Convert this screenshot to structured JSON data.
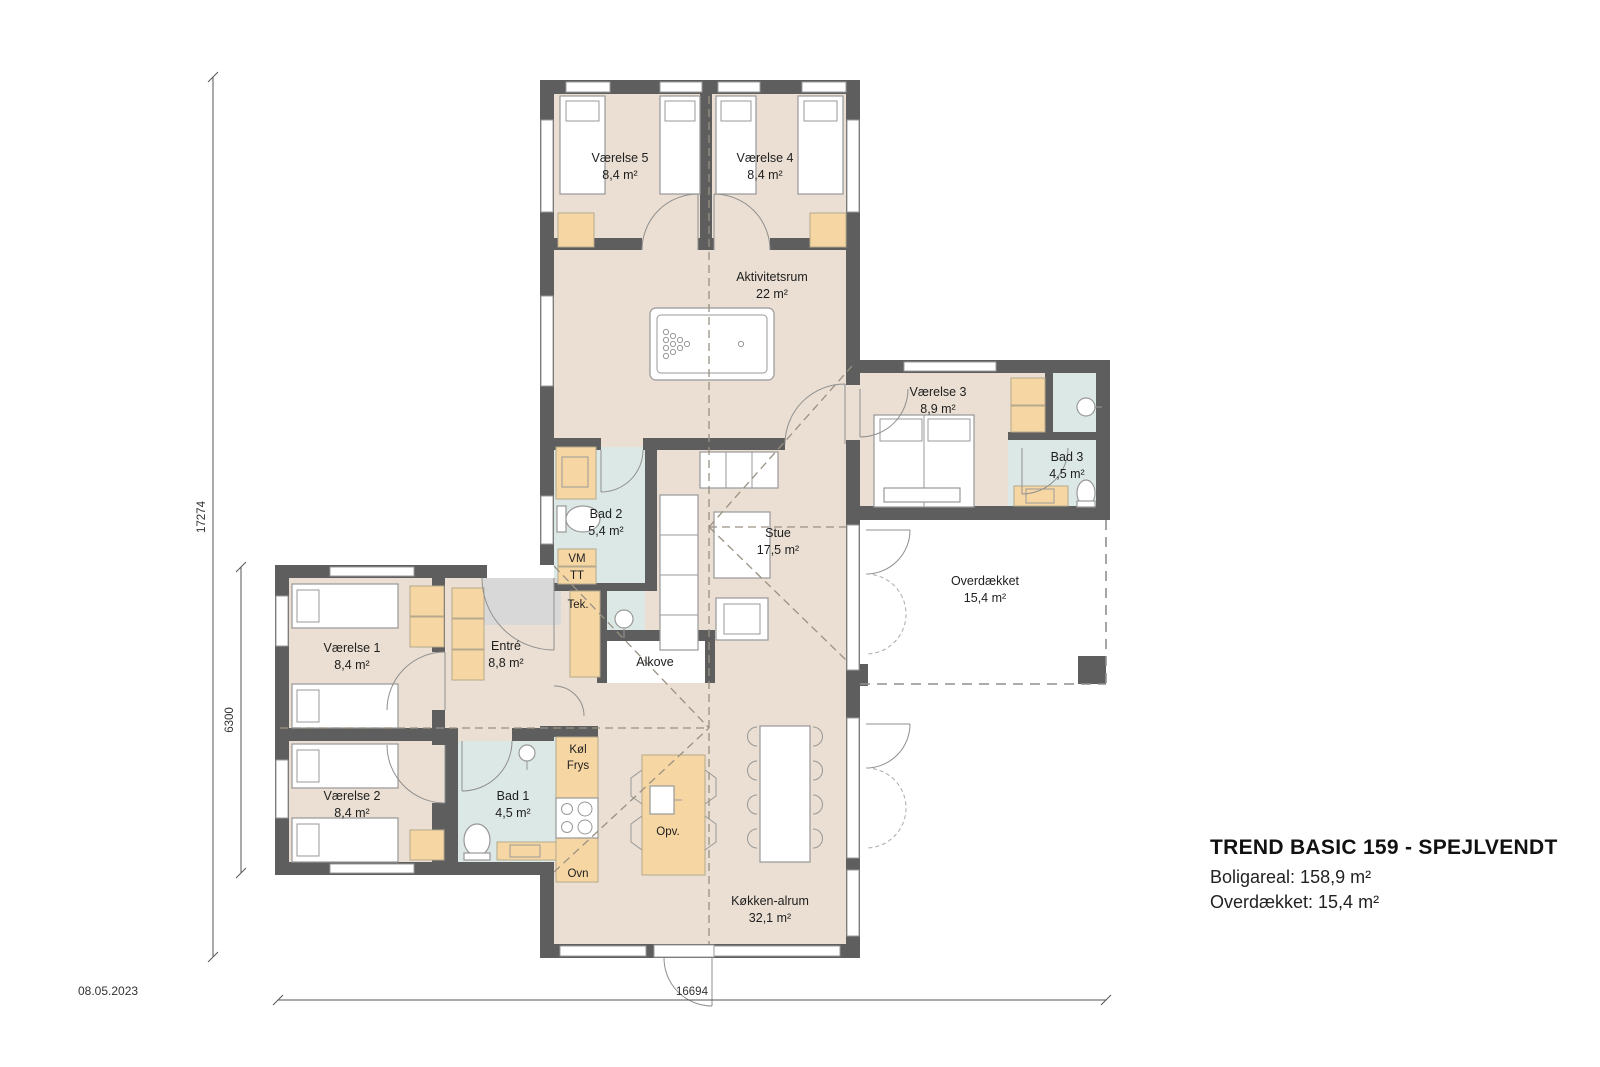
{
  "title_block": {
    "title": "TREND BASIC 159 - SPEJLVENDT",
    "boligareal": "Boligareal: 158,9 m²",
    "overdaekket": "Overdækket: 15,4 m²"
  },
  "date": "08.05.2023",
  "dimensions": {
    "total_height": "17274",
    "wing_height": "6300",
    "total_width": "16694"
  },
  "rooms": {
    "vaerelse5": {
      "name": "Værelse 5",
      "area": "8,4 m²"
    },
    "vaerelse4": {
      "name": "Værelse 4",
      "area": "8,4 m²"
    },
    "aktivitetsrum": {
      "name": "Aktivitetsrum",
      "area": "22 m²"
    },
    "vaerelse3": {
      "name": "Værelse 3",
      "area": "8,9 m²"
    },
    "bad3": {
      "name": "Bad 3",
      "area": "4,5 m²"
    },
    "bad2": {
      "name": "Bad 2",
      "area": "5,4 m²"
    },
    "stue": {
      "name": "Stue",
      "area": "17,5 m²"
    },
    "overdaekket": {
      "name": "Overdækket",
      "area": "15,4 m²"
    },
    "vaerelse1": {
      "name": "Værelse 1",
      "area": "8,4 m²"
    },
    "entre": {
      "name": "Entré",
      "area": "8,8 m²"
    },
    "vaerelse2": {
      "name": "Værelse 2",
      "area": "8,4 m²"
    },
    "bad1": {
      "name": "Bad 1",
      "area": "4,5 m²"
    },
    "koekken_alrum": {
      "name": "Køkken-alrum",
      "area": "32,1 m²"
    },
    "alkove": {
      "name": "Alkove"
    },
    "tek": {
      "name": "Tek."
    }
  },
  "appliances": {
    "vm": "VM",
    "tt": "TT",
    "koel": "Køl",
    "frys": "Frys",
    "ovn": "Ovn",
    "opv": "Opv."
  },
  "colors": {
    "wall": "#5e5e5e",
    "floor": "#eadfd2",
    "bath": "#dce8e6",
    "cabinet": "#f6d7a4",
    "mat": "#d8d8d8",
    "roof_dash": "#9a9183"
  }
}
